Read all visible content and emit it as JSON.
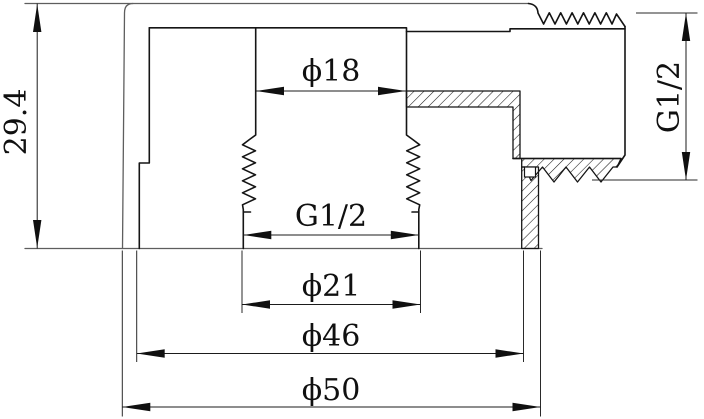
{
  "drawing": {
    "labels": {
      "overall_height": "29.4",
      "top_bore_diameter": "ϕ18",
      "center_thread": "G1/2",
      "thread_major_diameter": "ϕ21",
      "body_diameter": "ϕ46",
      "base_diameter": "ϕ50",
      "side_thread": "G1/2"
    }
  }
}
